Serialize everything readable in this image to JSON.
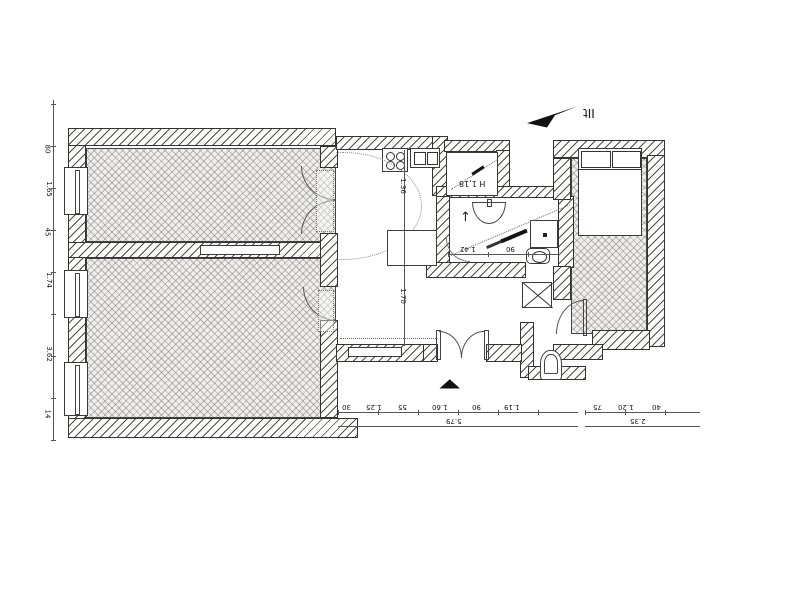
{
  "title": "apartment-floor-plan",
  "compass": {
    "marks": "IIt"
  },
  "labels": {
    "hall_height": "H 1,18"
  },
  "icons": {
    "entrance_marker": "▲",
    "bath_arrow": "↑"
  },
  "dims": {
    "left": [
      "80",
      "1.65",
      "45",
      "1.74",
      "3.62",
      "14"
    ],
    "bottom": [
      "30",
      "1.25",
      "55",
      "1.60",
      "90",
      "1.19"
    ],
    "bottom_total": "5.79",
    "right": [
      "75",
      "1.20",
      "40"
    ],
    "right_total": "2.35",
    "bath": [
      "1.42",
      "90"
    ],
    "kitchen": [
      "1.36",
      "1.70"
    ]
  }
}
